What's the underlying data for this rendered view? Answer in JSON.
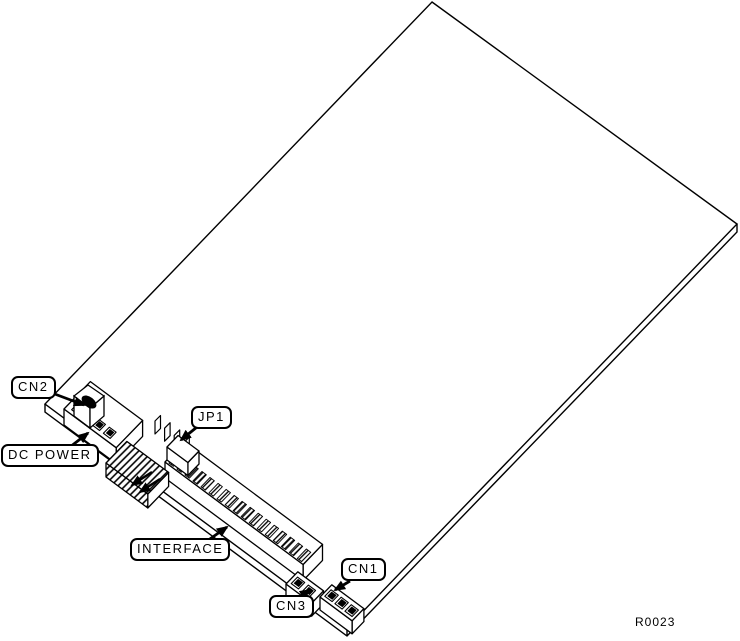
{
  "diagram": {
    "background_color": "#ffffff",
    "line_color": "#000000",
    "drawing_number": "R0023",
    "labels": {
      "cn2": "CN2",
      "dc_power": "DC POWER",
      "jp1": "JP1",
      "interface": "INTERFACE",
      "cn3": "CN3",
      "cn1": "CN1"
    }
  }
}
